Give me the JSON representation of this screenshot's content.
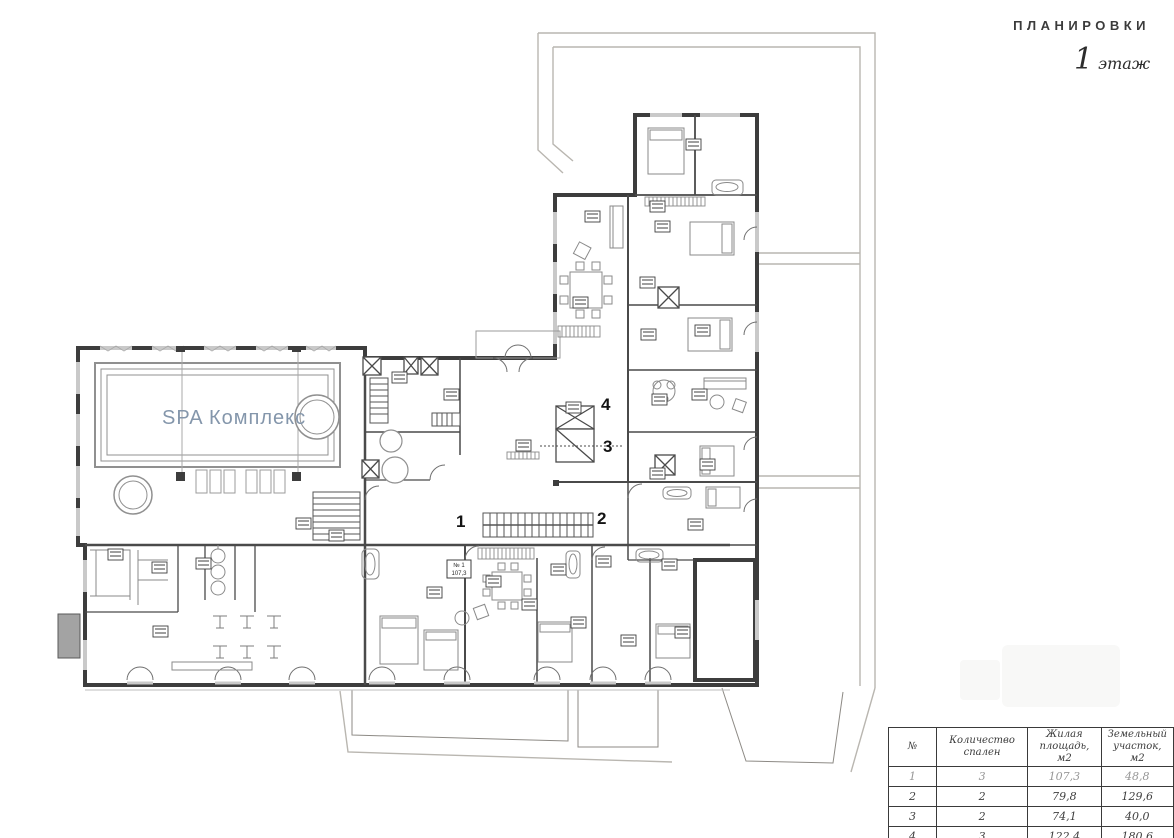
{
  "header": {
    "title": "ПЛАНИРОВКИ",
    "floor_number": "1",
    "floor_word": "этаж"
  },
  "plan": {
    "spa_label": "SPA  Комплекс",
    "apartment_numbers": {
      "a1": "1",
      "a2": "2",
      "a3": "3",
      "a4": "4"
    },
    "apartment1_tag": {
      "line1": "№ 1",
      "line2": "107,3"
    }
  },
  "table": {
    "columns": [
      "№",
      "Количество спален",
      "Жилая площадь, м2",
      "Земельный участок, м2"
    ],
    "rows": [
      [
        "1",
        "3",
        "107,3",
        "48,8"
      ],
      [
        "2",
        "2",
        "79,8",
        "129,6"
      ],
      [
        "3",
        "2",
        "74,1",
        "40,0"
      ],
      [
        "4",
        "3",
        "122,4",
        "180,6"
      ]
    ]
  },
  "colors": {
    "walls": "#3d3d3d",
    "plot_line": "#b9b6b0",
    "spa_text": "#8496ab",
    "accent_dark": "#1a1a1a"
  }
}
